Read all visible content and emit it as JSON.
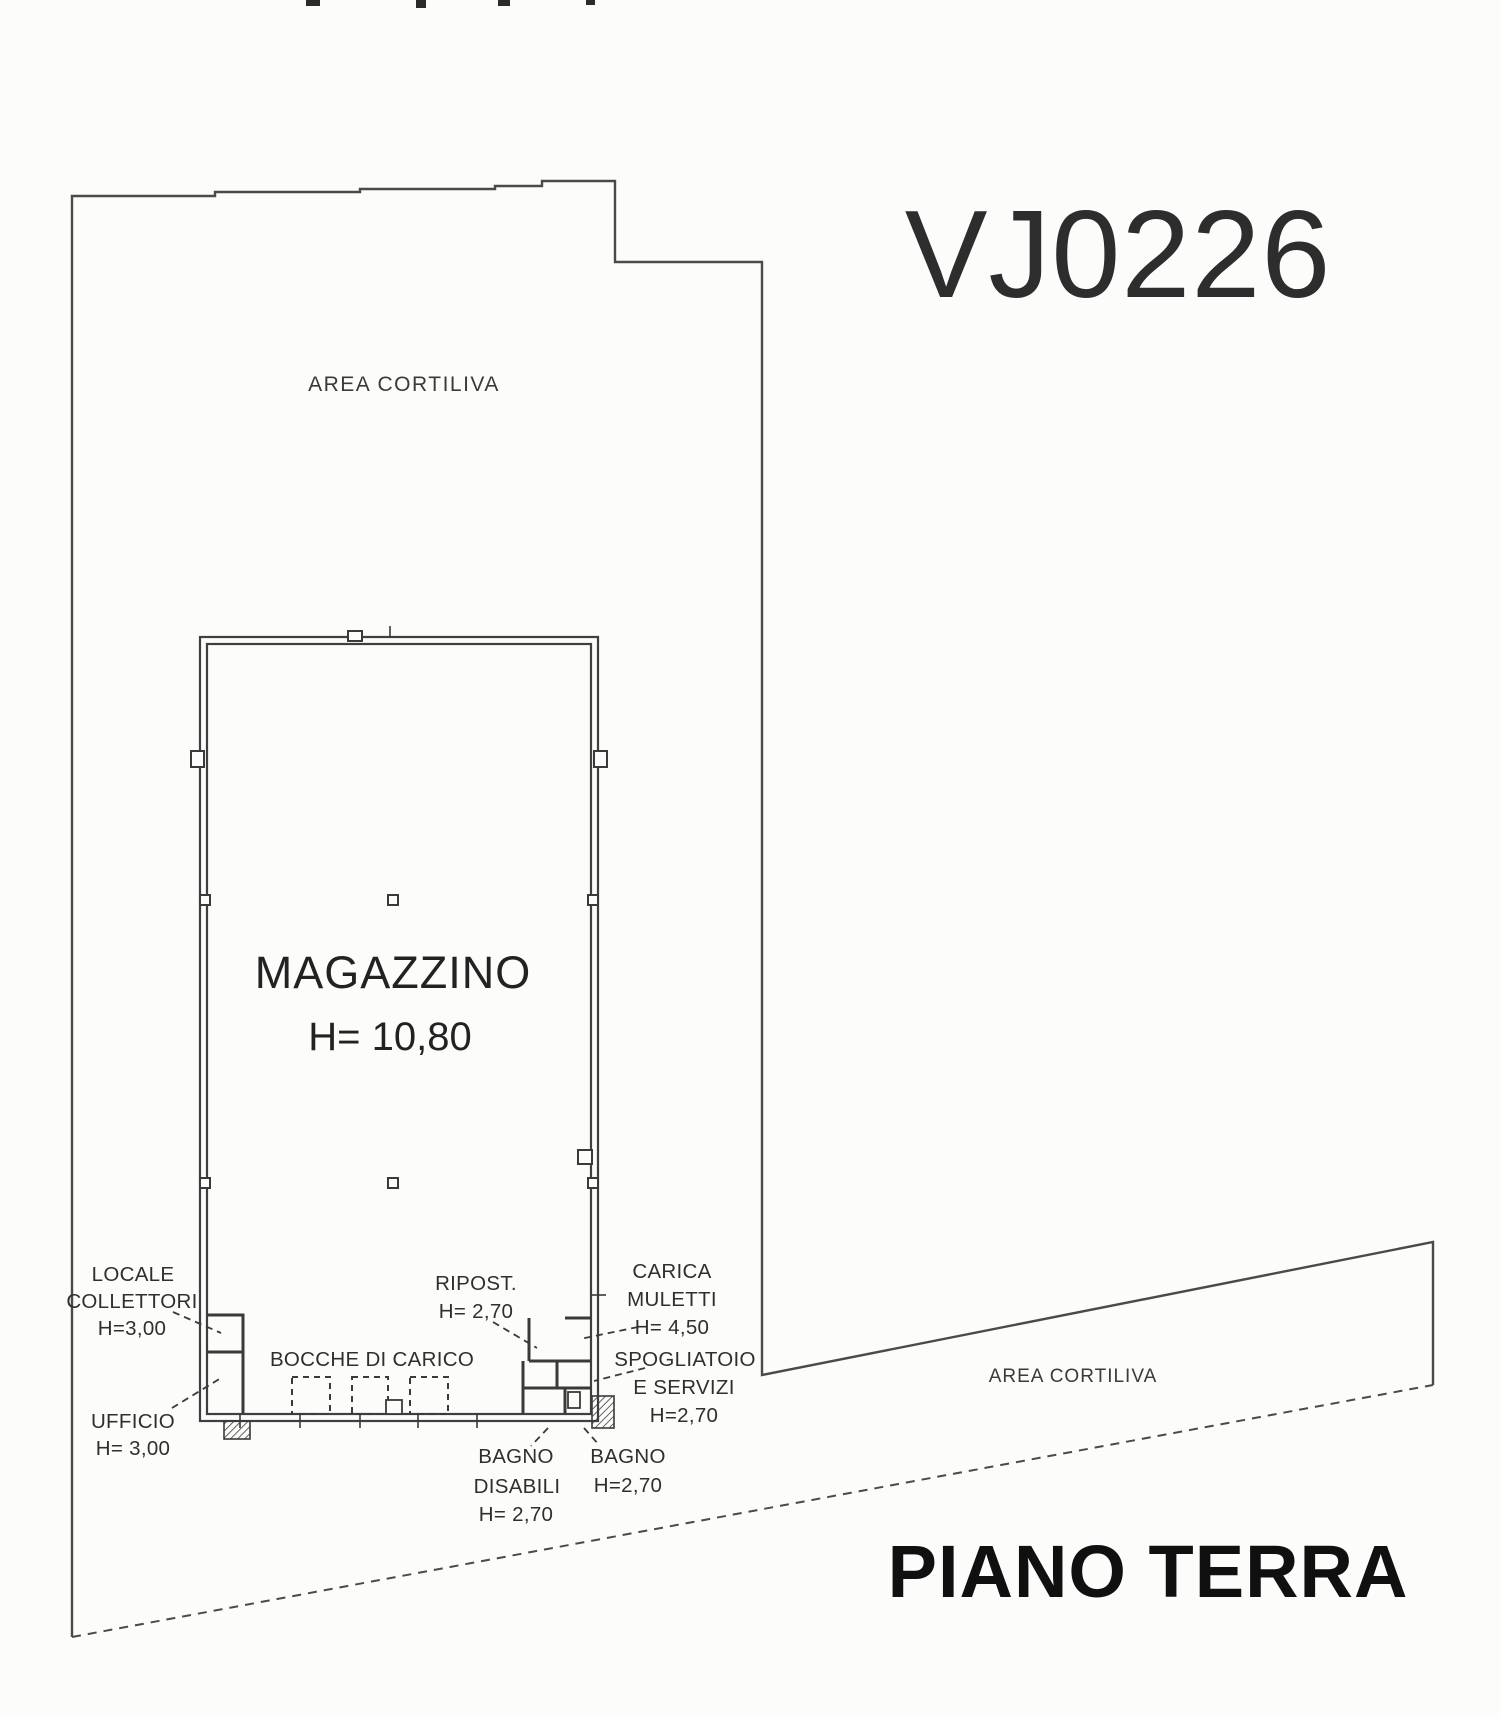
{
  "plan": {
    "code": "VJ0226",
    "floor_title": "PIANO TERRA",
    "colors": {
      "code_red": "#c9242b",
      "ink": "#3a3a3a",
      "paper": "#fcfcfb"
    },
    "areas": {
      "courtyard_top": "AREA CORTILIVA",
      "courtyard_right": "AREA CORTILIVA"
    },
    "rooms": {
      "magazzino": {
        "name": "MAGAZZINO",
        "height": "H= 10,80"
      },
      "locale_collettori": {
        "line1": "LOCALE",
        "line2": "COLLETTORI",
        "height": "H=3,00"
      },
      "ufficio": {
        "name": "UFFICIO",
        "height": "H= 3,00"
      },
      "bocche_di_carico": {
        "name": "BOCCHE DI CARICO"
      },
      "ripostiglio": {
        "name": "RIPOST.",
        "height": "H= 2,70"
      },
      "carica_muletti": {
        "line1": "CARICA",
        "line2": "MULETTI",
        "height": "H= 4,50"
      },
      "spogliatoio": {
        "line1": "SPOGLIATOIO",
        "line2": "E SERVIZI",
        "height": "H=2,70"
      },
      "bagno_disabili": {
        "line1": "BAGNO",
        "line2": "DISABILI",
        "height": "H= 2,70"
      },
      "bagno": {
        "name": "BAGNO",
        "height": "H=2,70"
      }
    }
  }
}
